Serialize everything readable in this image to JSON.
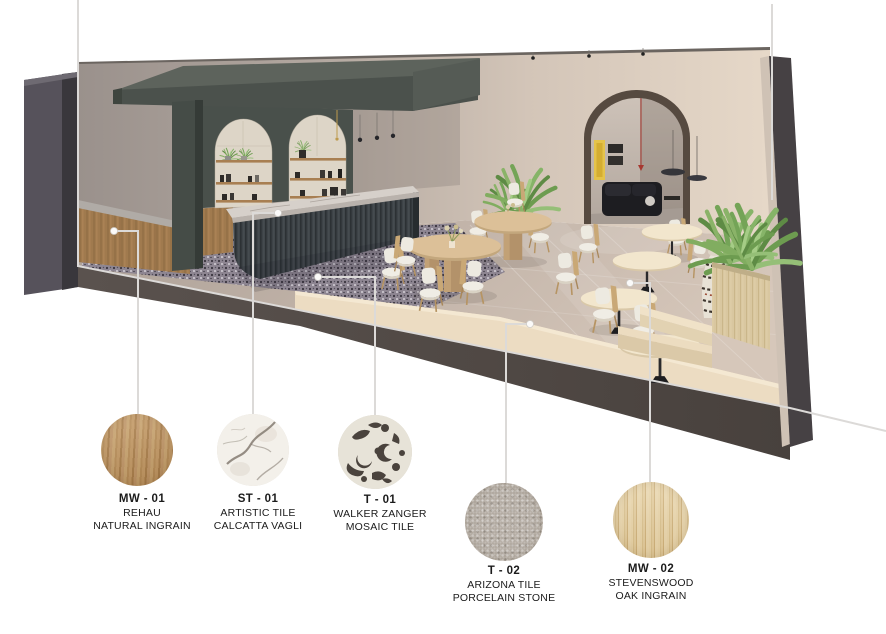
{
  "board": {
    "background_color": "#ffffff",
    "leader_line_color": "#dcdad8",
    "materials": [
      {
        "code": "MW - 01",
        "brand": "REHAU",
        "product": "NATURAL INGRAIN",
        "finish": "medium-wood-grain",
        "color": "#c19a63"
      },
      {
        "code": "ST - 01",
        "brand": "ARTISTIC TILE",
        "product": "CALCATTA VAGLI",
        "finish": "white-marble",
        "color": "#f3f0ea"
      },
      {
        "code": "T - 01",
        "brand": "WALKER ZANGER",
        "product": "MOSAIC TILE",
        "finish": "organic-mosaic",
        "color": "#e7e3d8"
      },
      {
        "code": "T - 02",
        "brand": "ARIZONA TILE",
        "product": "PORCELAIN STONE",
        "finish": "grey-speckled-stone",
        "color": "#b2aaa1"
      },
      {
        "code": "MW - 02",
        "brand": "STEVENSWOOD",
        "product": "OAK INGRAIN",
        "finish": "light-oak-grain",
        "color": "#e0c997"
      }
    ]
  }
}
